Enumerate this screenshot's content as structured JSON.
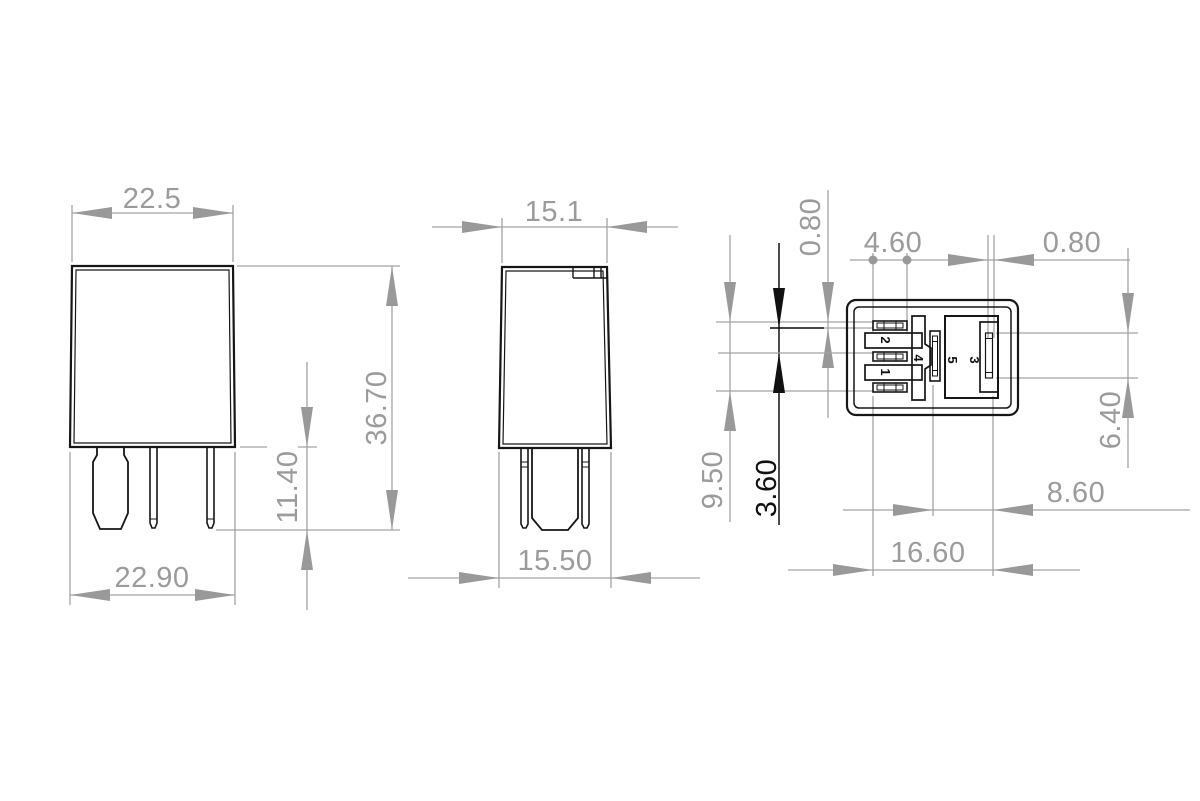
{
  "drawing": {
    "type": "technical-dimension-drawing",
    "subject": "5-pin automotive micro relay, three orthographic views",
    "units": "mm",
    "colors": {
      "outline": "#161616",
      "dimension": "#9b9b9b",
      "dimension_line": "#a3a3a3",
      "dimension_highlight": "#111111",
      "background": "#ffffff"
    },
    "views": {
      "front": {
        "dims": {
          "top_width": "22.5",
          "bottom_width": "22.90",
          "overall_height": "36.70",
          "pin_length": "11.40"
        }
      },
      "side": {
        "dims": {
          "top_width": "15.1",
          "bottom_width": "15.50"
        }
      },
      "bottom": {
        "dims": {
          "blade_thickness_left": "0.80",
          "coil_slot_length": "4.60",
          "pin3_blade_thickness": "0.80",
          "pin3_blade_length": "6.40",
          "pin3_offset": "8.60",
          "pin_span_width": "16.60",
          "pin_span_height": "9.50",
          "coil_pitch": "3.60"
        },
        "pin_labels": {
          "p1": "1",
          "p2": "2",
          "p3": "3",
          "p4": "4",
          "p5": "5"
        }
      }
    }
  }
}
